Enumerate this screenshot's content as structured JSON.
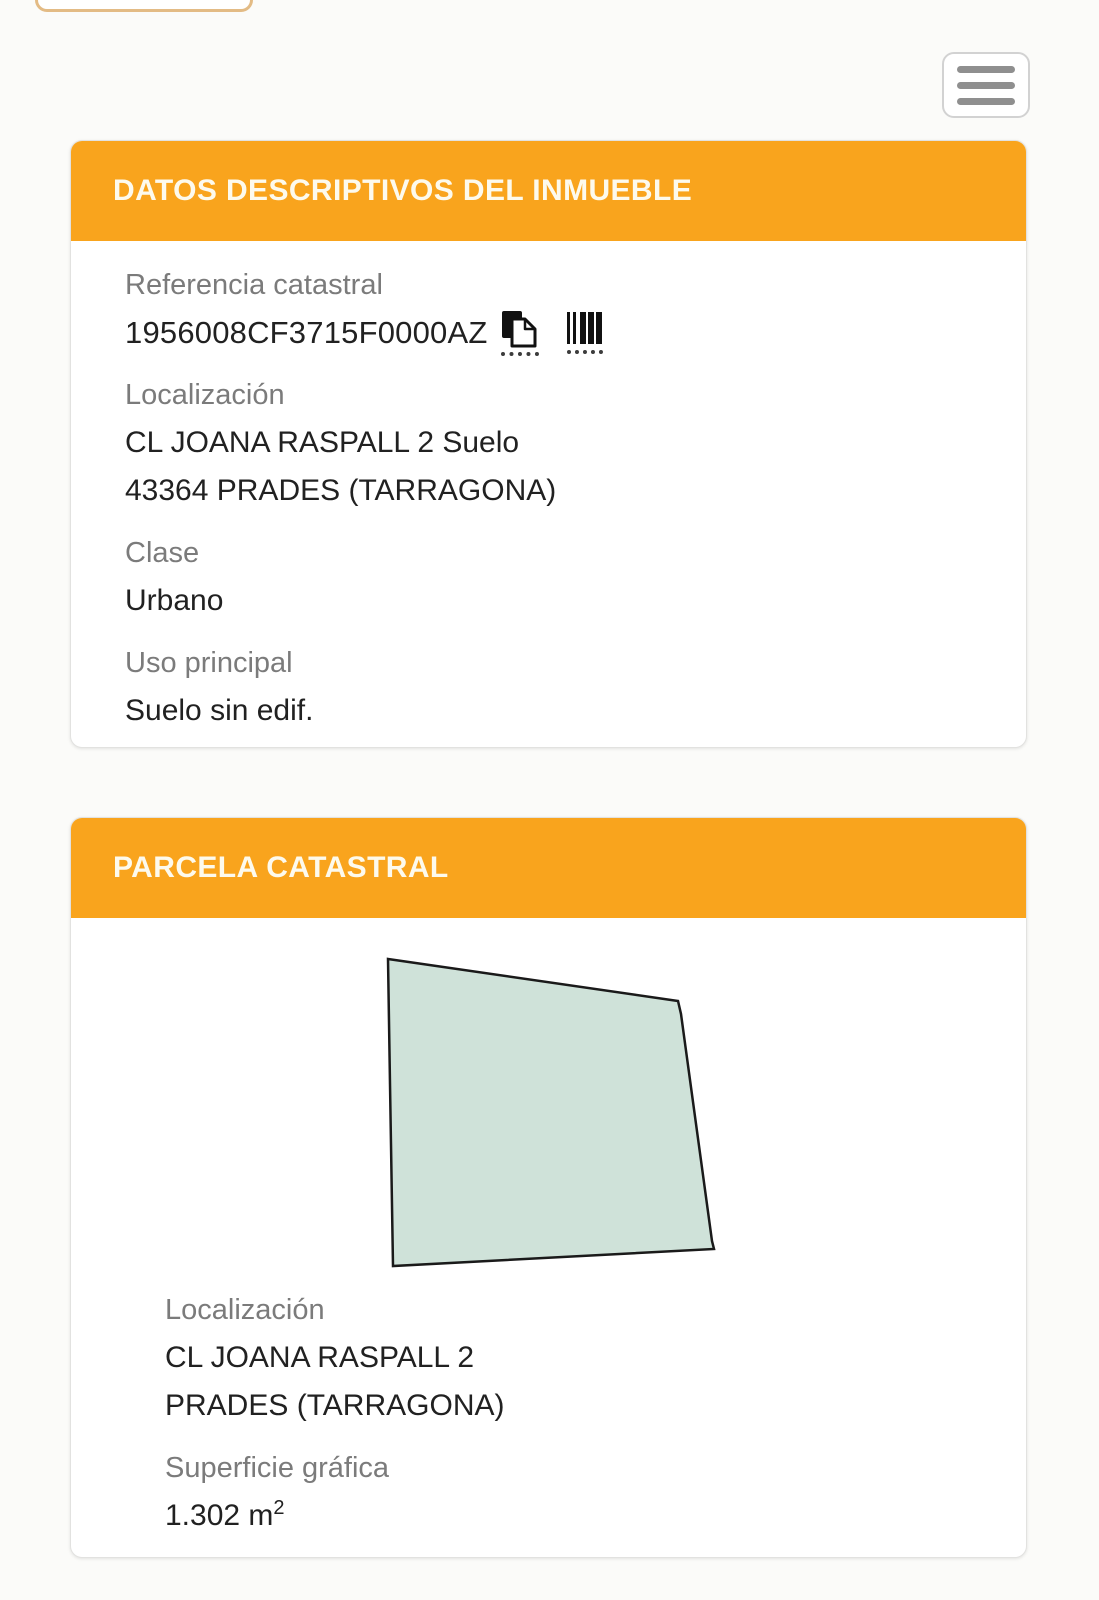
{
  "colors": {
    "accent_orange": "#f9a41d",
    "header_text": "#fdfaed",
    "label_gray": "#7b7b7b",
    "value_dark": "#212121",
    "parcel_fill": "#cfe2d9",
    "parcel_stroke": "#1a1a1a"
  },
  "top_bar": {
    "menu_icon": "hamburger-icon"
  },
  "property_card": {
    "title": "DATOS DESCRIPTIVOS DEL INMUEBLE",
    "reference": {
      "label": "Referencia catastral",
      "value": "1956008CF3715F0000AZ",
      "icons": [
        "copy-icon",
        "barcode-icon"
      ]
    },
    "location": {
      "label": "Localización",
      "lines": [
        "CL JOANA RASPALL 2 Suelo",
        "43364 PRADES (TARRAGONA)"
      ]
    },
    "clase": {
      "label": "Clase",
      "value": "Urbano"
    },
    "uso": {
      "label": "Uso principal",
      "value": "Suelo sin edif."
    }
  },
  "parcel_card": {
    "title": "PARCELA CATASTRAL",
    "polygon_points": "57,38 347,80 350,93 381,320 383,328 62,345 59,163",
    "location": {
      "label": "Localización",
      "lines": [
        "CL JOANA RASPALL 2",
        "PRADES (TARRAGONA)"
      ]
    },
    "superficie": {
      "label": "Superficie gráfica",
      "value": "1.302 m",
      "sup": "2"
    }
  }
}
